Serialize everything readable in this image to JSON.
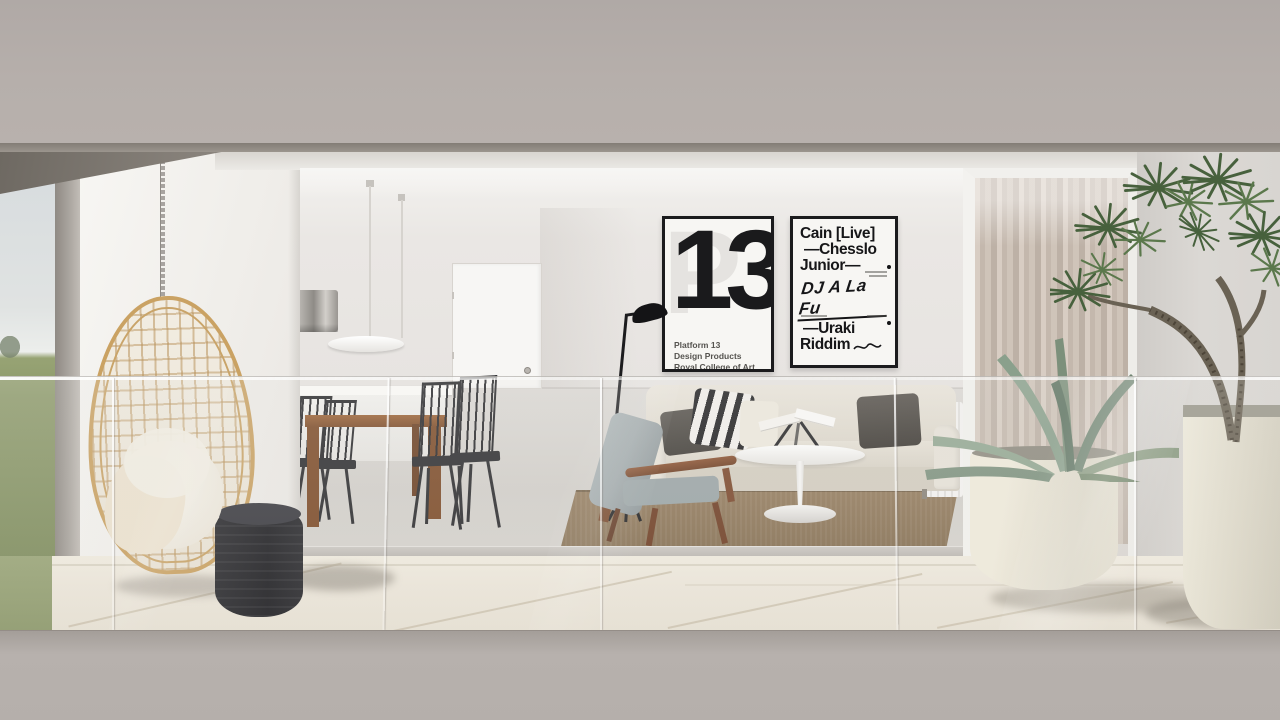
{
  "scene": {
    "description": "Architectural render: modern apartment living room seen through a glass balustrade balcony, with hanging rattan chair, dining set, sofa, posters, plants",
    "palette": {
      "facade_band": "#b6afab",
      "soffit": "#8a847d",
      "tile": "#ece6da",
      "grass": "#8d9a6b",
      "sky": "#d9dee0",
      "rattan": "#caa263",
      "sofa": "#ded9cd",
      "rug": "#8b7457",
      "wood": "#7c4a27",
      "foliage": "#4f6a44",
      "curtain": "#ccc0b5",
      "pouf": "#26262a"
    }
  },
  "posters": {
    "platform13": {
      "ghost_letter": "P",
      "number": "13",
      "lines": [
        "Platform 13",
        "Design Products",
        "Royal College of Art"
      ]
    },
    "lineup": {
      "line1": "Cain [Live]",
      "line2": "—Chesslo",
      "line3": "Junior—",
      "handwritten": "DJ A La Fu",
      "line4": "—Uraki",
      "line5": "Riddim"
    }
  }
}
